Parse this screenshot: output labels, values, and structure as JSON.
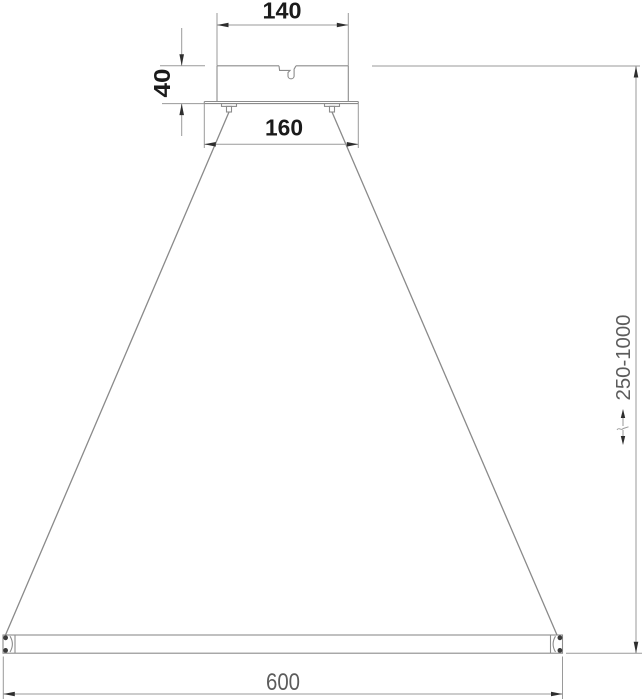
{
  "drawing": {
    "background_color": "#ffffff",
    "line_color": "#8c8c8c",
    "arrow_color": "#2e2e2e",
    "primary_text_color": "#1b1b1b",
    "secondary_text_color": "#5c5c5c",
    "dimensions": {
      "canopy_width": "140",
      "canopy_height": "40",
      "mount_plate_width": "160",
      "bar_length": "600",
      "suspension_height_range": "250-1000"
    }
  }
}
